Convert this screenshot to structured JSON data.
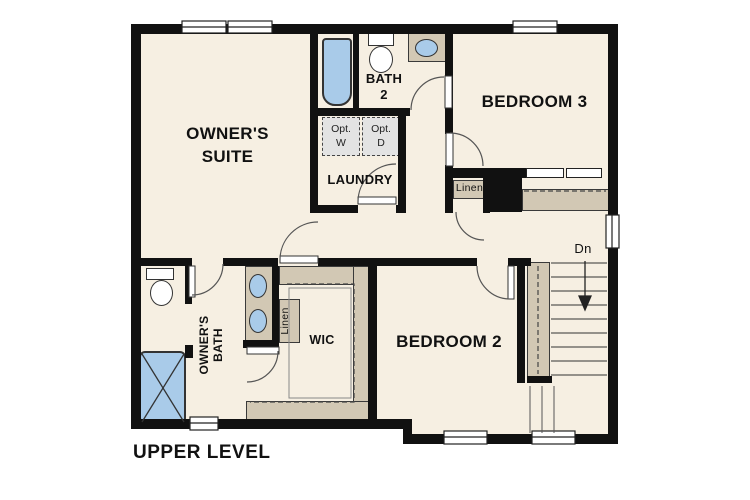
{
  "plan": {
    "title": "UPPER LEVEL",
    "rooms": {
      "owners_suite": "OWNER'S\nSUITE",
      "bath2": "BATH\n2",
      "laundry": "LAUNDRY",
      "bedroom3": "BEDROOM 3",
      "bedroom2": "BEDROOM 2",
      "owners_bath": "OWNER'S\nBATH",
      "wic": "WIC",
      "linen_hall": "Linen",
      "linen_bath": "Linen",
      "opt_washer": "Opt.\nW",
      "opt_dryer": "Opt.\nD",
      "stairs_down": "Dn"
    },
    "colors": {
      "wall": "#111111",
      "floor": "#f6efe2",
      "counter": "#d2c8b4",
      "fixture_blue": "#a9cbe9",
      "optional_gray": "#e3e3e3"
    }
  }
}
